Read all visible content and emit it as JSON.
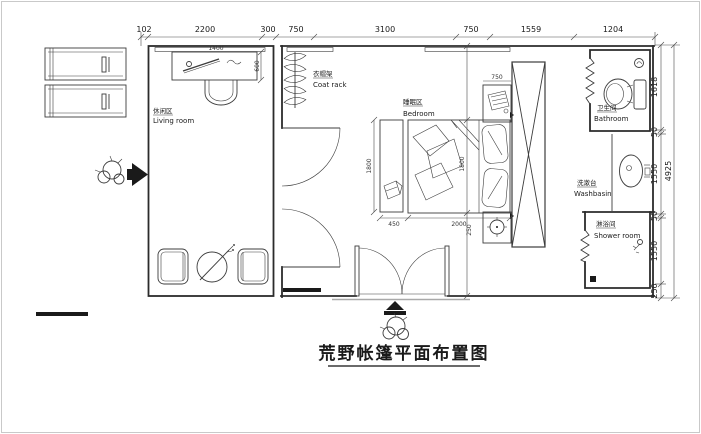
{
  "title": "荒野帐篷平面布置图",
  "rooms": {
    "living": {
      "zh": "休闲区",
      "en": "Living room"
    },
    "coat_rack": {
      "zh": "衣帽架",
      "en": "Coat rack"
    },
    "bedroom": {
      "zh": "睡眠区",
      "en": "Bedroom"
    },
    "bathroom": {
      "zh": "卫生间",
      "en": "Bathroom"
    },
    "washbasin": {
      "zh": "洗漱台",
      "en": "Washbasin"
    },
    "shower": {
      "zh": "淋浴间",
      "en": "Shower room"
    }
  },
  "dims": {
    "top": [
      "102",
      "2200",
      "300",
      "750",
      "3100",
      "750",
      "1559",
      "1204"
    ],
    "right": [
      "1618",
      "50",
      "1550",
      "50",
      "1550",
      "250"
    ],
    "right_total": "4925",
    "desk_width": "1400",
    "desk_depth": "600",
    "bench_width": "450",
    "bed_length": "2000",
    "bed_width": "1800",
    "bed_head_nook": "750",
    "bed_foot_gap": "250"
  },
  "colors": {
    "line": "#2b2b2b",
    "furniture": "#3c3c3c",
    "dim": "#4a4a4a",
    "text": "#1a1a1a",
    "frame": "#c9c9c9"
  }
}
